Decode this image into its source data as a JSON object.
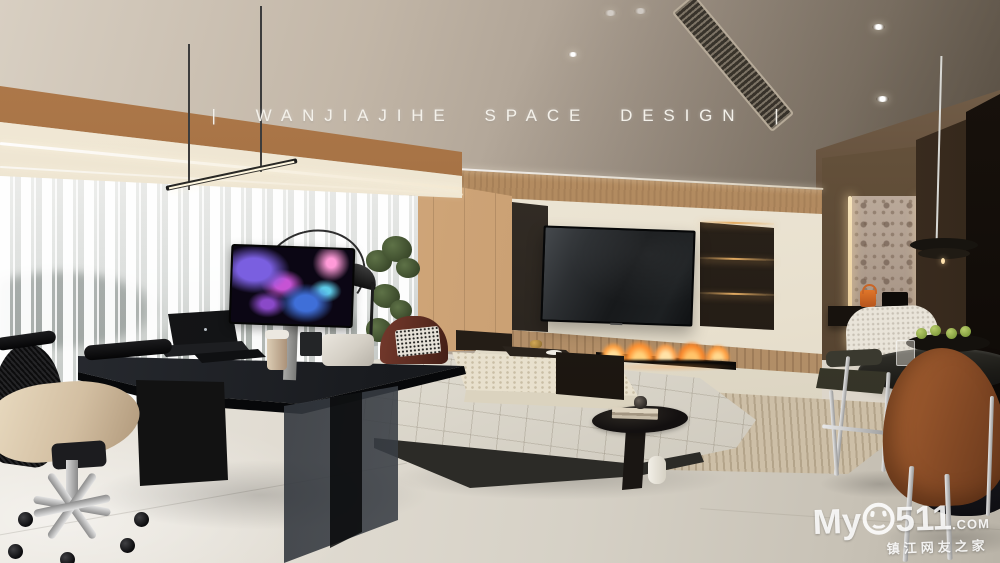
{
  "image": {
    "width": 1000,
    "height": 563,
    "kind": "interior design render",
    "scene": "modern home office and living room with media wall, linear fireplace, white modular sofa, black executive desk and dining corner"
  },
  "overlay_title": {
    "text": "| WANJIAJIHE SPACE DESIGN |"
  },
  "watermark": {
    "prefix": "My",
    "zero_glyph": "smiley-face-icon",
    "number": "511",
    "domain": ".COM",
    "tagline": "镇江网友之家"
  },
  "palette": {
    "ceiling": "#bdb1a2",
    "wood_beam": "#9e6c3e",
    "blinds": "#f4f4f2",
    "media_wall": "#eae3d2",
    "wood_slats": "#b28a5e",
    "tv_screen": "#17191b",
    "leather_panels": "#281f17",
    "panel_glow": "#e0a860",
    "flame": "#ff9e3e",
    "bench": "#e9e3d4",
    "floor": "#d9d4c9",
    "rug": "#cdbfa7",
    "sofa": "#e9e5da",
    "desk": "#14161a",
    "marble_leg": "#131313",
    "monitor_art": [
      "#7a5fe0",
      "#c653d4",
      "#3f6fd8",
      "#5ecbe8",
      "#ff9ad8"
    ],
    "right_wall": "#5d4a38",
    "stone_niche": "#b4a496",
    "led_strip": "#f2ddb0",
    "dining_table": "#23221e",
    "rust_chair": "#8d4f28",
    "olive_chair": "#3b3a30",
    "chrome": "#cfcfcf",
    "accent_bag": "#d86a1f",
    "apples": "#8fa844"
  }
}
